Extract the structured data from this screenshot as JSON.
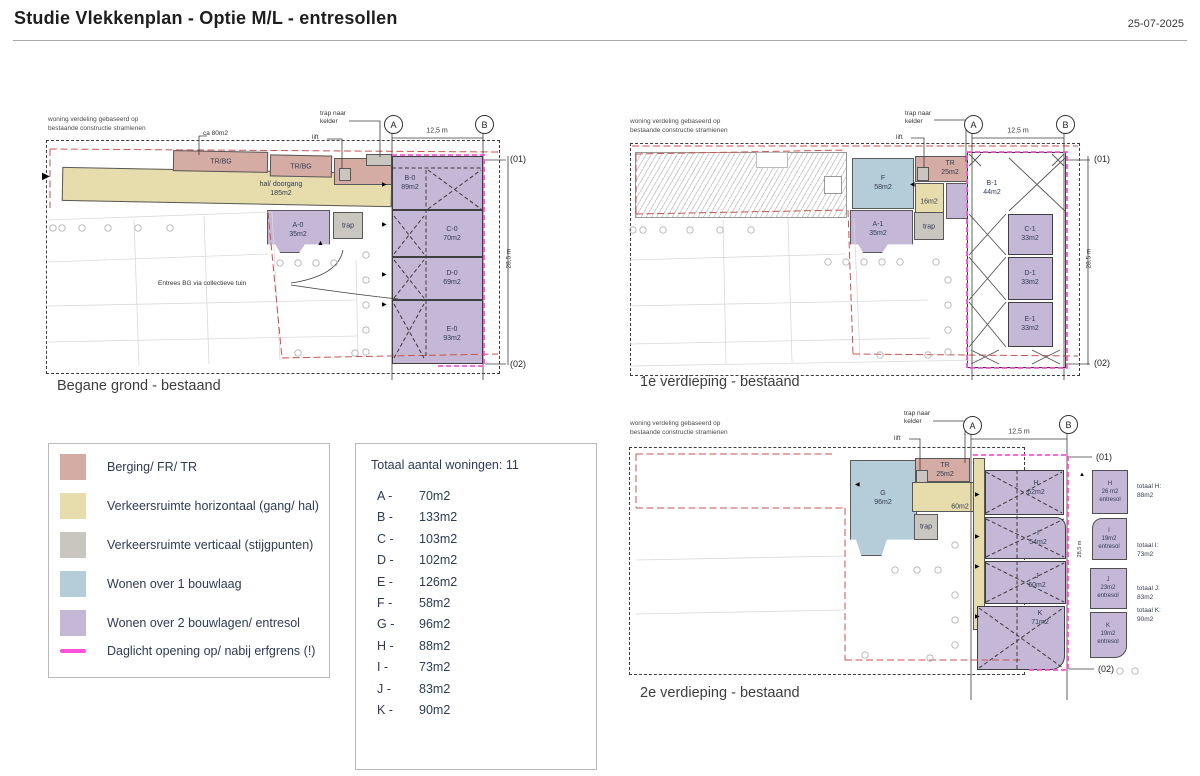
{
  "header": {
    "title": "Studie Vlekkenplan - Optie M/L - entresollen",
    "date": "25-07-2025"
  },
  "colors": {
    "berging": "#d5aca3",
    "verkeer_horizontaal": "#e7dcab",
    "verkeer_verticaal": "#c9c6c0",
    "wonen_1_bouwlaag": "#b5ccd9",
    "wonen_2_bouwlagen": "#c4b8d6",
    "daglicht_lijn": "#ff52d8",
    "erfgrens_rood": "#c9534d"
  },
  "legend": {
    "items": [
      {
        "label": "Berging/ FR/ TR",
        "color": "#d5aca3"
      },
      {
        "label": "Verkeersruimte horizontaal (gang/ hal)",
        "color": "#e7dcab"
      },
      {
        "label": "Verkeersruimte verticaal (stijgpunten)",
        "color": "#c9c6c0"
      },
      {
        "label": "Wonen over 1 bouwlaag",
        "color": "#b5ccd9"
      },
      {
        "label": "Wonen over 2 bouwlagen/ entresol",
        "color": "#c4b8d6"
      },
      {
        "label": "Daglicht opening op/ nabij erfgrens (!)",
        "color": "#ff52d8"
      }
    ]
  },
  "totals": {
    "title": "Totaal aantal woningen: 11",
    "rows": [
      {
        "key": "A -",
        "value": "70m2"
      },
      {
        "key": "B -",
        "value": "133m2"
      },
      {
        "key": "C -",
        "value": "103m2"
      },
      {
        "key": "D -",
        "value": "102m2"
      },
      {
        "key": "E -",
        "value": "126m2"
      },
      {
        "key": "F -",
        "value": "58m2"
      },
      {
        "key": "G -",
        "value": "96m2"
      },
      {
        "key": "H -",
        "value": "88m2"
      },
      {
        "key": "I -",
        "value": "73m2"
      },
      {
        "key": "J -",
        "value": "83m2"
      },
      {
        "key": "K -",
        "value": "90m2"
      }
    ]
  },
  "plans": {
    "bg": {
      "caption": "Begane grond - bestaand",
      "note": "woning verdeling gebaseerd op\nbestaande constructie stramienen",
      "ann": {
        "ca80": "ca 80m2",
        "trap_kelder": "trap naar\nkelder",
        "lift": "lift",
        "entrees": "Entrees BG via collectieve tuin"
      },
      "grid": {
        "a": "A",
        "b": "B",
        "dim": "12,5 m",
        "vdim": "28,5 m",
        "m1": "(01)",
        "m2": "(02)"
      },
      "rooms": {
        "trbg1": "TR/BG",
        "trbg2": "TR/BG",
        "hal": "hal/ doorgang\n185m2",
        "a0": "A-0\n35m2",
        "trap": "trap",
        "b0": "B-0\n89m2",
        "c0": "C-0\n70m2",
        "d0": "D-0\n69m2",
        "e0": "E-0\n93m2"
      }
    },
    "v1": {
      "caption": "1e verdieping - bestaand",
      "note": "woning verdeling gebaseerd op\nbestaande constructie stramienen",
      "ann": {
        "trap_kelder": "trap naar\nkelder",
        "lift": "lift"
      },
      "grid": {
        "a": "A",
        "b": "B",
        "dim": "12,5 m",
        "vdim": "28,5 m",
        "m1": "(01)",
        "m2": "(02)"
      },
      "rooms": {
        "f": "F\n58m2",
        "tr": "TR\n25m2",
        "c16": "16m2",
        "b1": "B-1\n44m2",
        "a1": "A-1\n35m2",
        "trap": "trap",
        "c1": "C-1\n33m2",
        "d1": "D-1\n33m2",
        "e1": "E-1\n33m2"
      }
    },
    "v2": {
      "caption": "2e verdieping - bestaand",
      "note": "woning verdeling gebaseerd op\nbestaande constructie stramienen",
      "ann": {
        "trap_kelder": "trap naar\nkelder",
        "lift": "lift"
      },
      "grid": {
        "a": "A",
        "b": "B",
        "dim": "12,5 m",
        "vdim": "28,5 m",
        "m1": "(01)",
        "m2": "(02)"
      },
      "rooms": {
        "g": "G\n96m2",
        "tr": "TR\n25m2",
        "c60": "60m2",
        "trap": "trap",
        "h": "H\n62m2",
        "i": "I\n54m2",
        "j": "J\n60m2",
        "k": "K\n71m2"
      },
      "entresol": [
        {
          "box": "H\n26 m2\nentresol",
          "total": "totaal H:\n88m2"
        },
        {
          "box": "I\n19m2\nentresol",
          "total": "totaal I:\n73m2"
        },
        {
          "box": "J\n23m2\nentresol",
          "total": "totaal J:\n83m2"
        },
        {
          "box": "K\n19m2\nentresol",
          "total": "totaal K:\n90m2"
        }
      ]
    }
  }
}
